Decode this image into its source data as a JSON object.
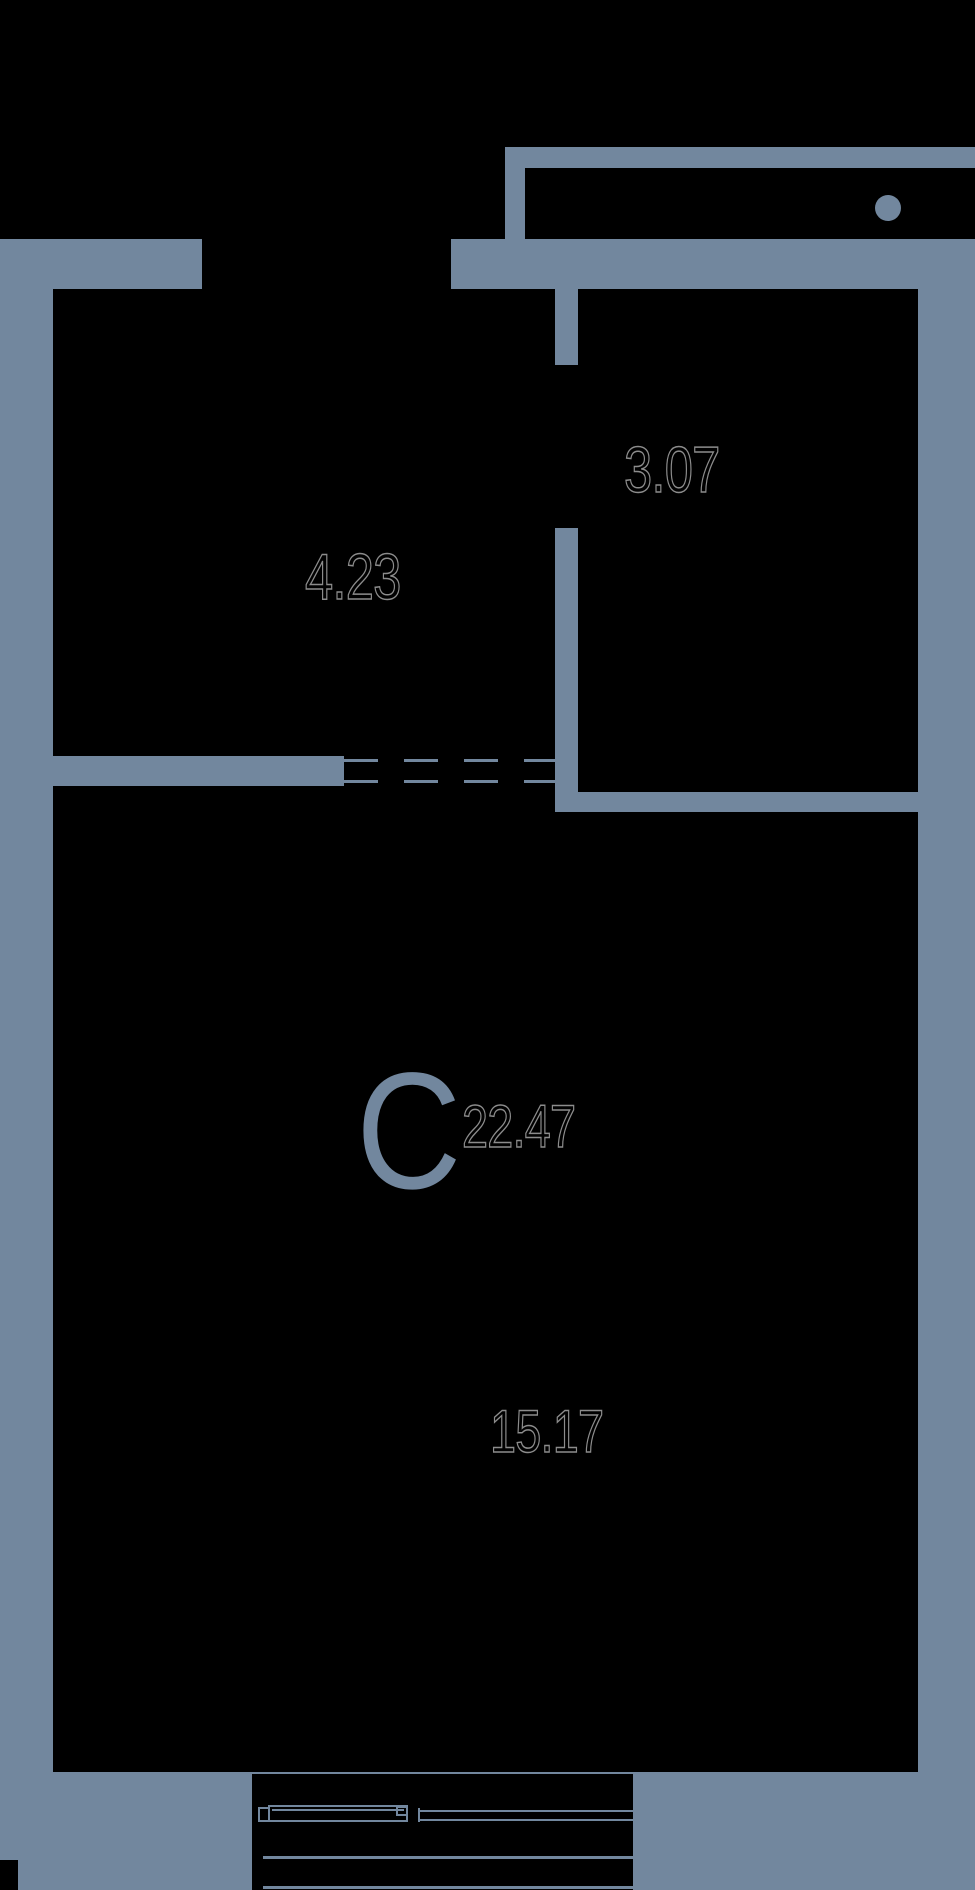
{
  "title": "Studio apartment floor plan",
  "colors": {
    "background": "#000000",
    "wall": "#72879E",
    "digit_outline": "#8c8c8c",
    "studio_letter_color": "#72879E"
  },
  "labels": {
    "studio_letter": "C",
    "studio_area": "22.47",
    "kitchen_zone_area": "15.17",
    "hall_area": "4.23",
    "bathroom_area": "3.07"
  }
}
